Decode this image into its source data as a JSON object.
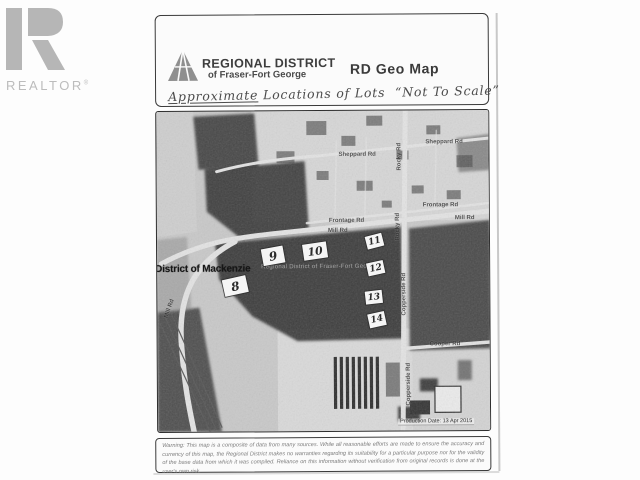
{
  "realtor": {
    "label": "REALTOR",
    "reg": "®"
  },
  "header": {
    "org_line1": "REGIONAL DISTRICT",
    "org_line2": "of Fraser-Fort George",
    "title": "RD Geo Map"
  },
  "annotation": {
    "word1": "Approximate",
    "rest": "Locations of Lots",
    "quoted": "“Not To Scale”"
  },
  "map": {
    "city_label": "District of Mackenzie",
    "watermark": "Regional District of Fraser-Fort George",
    "production_date": "Production Date: 13 Apr 2015",
    "road_labels": [
      {
        "text": "Sheppard Rd"
      },
      {
        "text": "Sheppard Rd"
      },
      {
        "text": "Frontage Rd"
      },
      {
        "text": "Mill Rd"
      },
      {
        "text": "Frontage Rd"
      },
      {
        "text": "Mill Rd"
      },
      {
        "text": "Rocky Rd"
      },
      {
        "text": "Rocky Rd"
      },
      {
        "text": "Copperside Rd"
      },
      {
        "text": "Copperside Rd"
      },
      {
        "text": "Cooper Rd"
      },
      {
        "text": "Mill Rd"
      }
    ],
    "lots": [
      "8",
      "9",
      "10",
      "11",
      "12",
      "13",
      "14"
    ]
  },
  "footer": {
    "disclaimer": "Warning: This map is a composite of data from many sources. While all reasonable efforts are made to ensure the accuracy and currency of this map, the Regional District makes no warranties regarding its suitability for a particular purpose nor for the validity of the base data from which it was compiled. Reliance on this information without verification from original records is done at the user's own risk."
  }
}
